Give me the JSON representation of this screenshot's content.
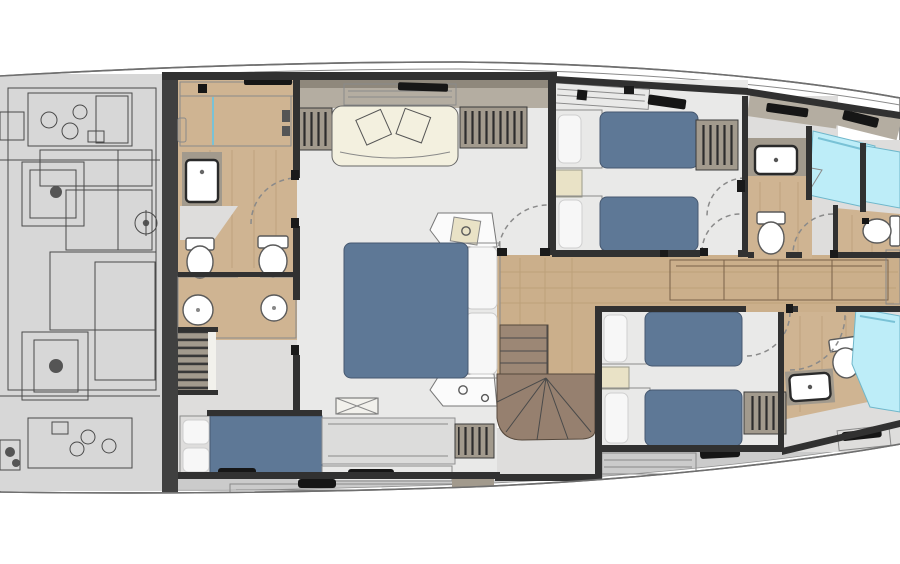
{
  "plan": {
    "kind": "yacht-lower-deck-floor-plan",
    "elements": [
      "hull",
      "engine-room",
      "bulkhead",
      "aft-bathroom",
      "shower",
      "wet-room",
      "toilet",
      "sink",
      "master-cabin",
      "sofa",
      "double-bed",
      "pillow",
      "nightstand",
      "wardrobe",
      "berth",
      "staircase",
      "corridor",
      "sideboard",
      "twin-cabin",
      "single-bed",
      "radiator-hatch",
      "deck-locker",
      "door-swing"
    ]
  },
  "colors": {
    "hull_fill": "#ffffff",
    "hull_line": "#7d7d7d",
    "wall": "#313131",
    "jamb": "#1a1a1a",
    "bulkhead": "#404040",
    "engine_fill": "#d7d7d7",
    "engine_shape": "#e3e3e3",
    "engine_dark": "#555555",
    "floor": "#e9e9e8",
    "floor_dim": "#dedddc",
    "wood": "#cfb492",
    "wood_corridor": "#cbaf8b",
    "cabinet_wood": "#c3a277",
    "shower": "#bdedf8",
    "bed": "#5e7896",
    "pillow": "#f7f7f7",
    "bed_frame": "#fbfbfb",
    "sofa": "#f3f0df",
    "nightstand": "#e9e2c6",
    "khaki": "#a29a8d",
    "band": "#b4ada1",
    "band_dark": "#8f887c",
    "shelf": "#f2f1ec",
    "stair": "#9c8775",
    "stair_dark": "#96806f",
    "deck": "#cbcbcb",
    "slats": "#f0f0ef",
    "fixture": "#ffffff",
    "black": "#161616",
    "dresser": "#dcdcdb"
  }
}
